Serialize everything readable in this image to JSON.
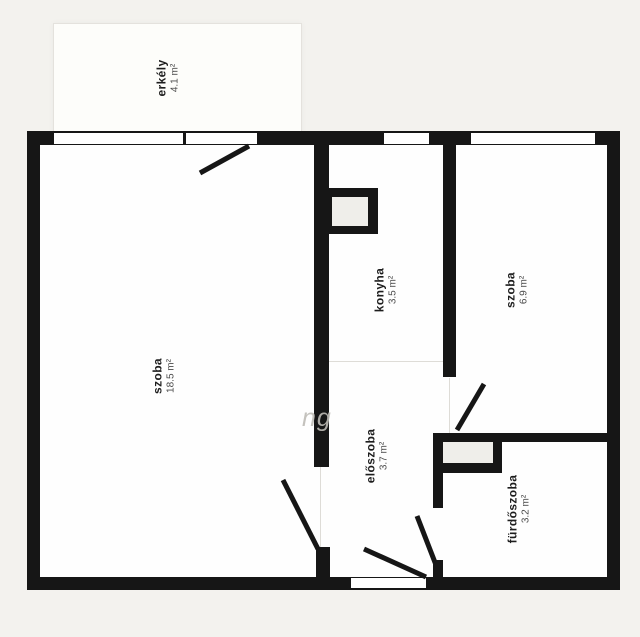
{
  "plan_type": "apartment-floor-plan",
  "colors": {
    "background": "#f3f2ee",
    "wall": "#161616",
    "room_fill": "#fefefe",
    "balcony_fill": "#fdfdfa",
    "shaft_fill": "#efeeea",
    "label_name": "#1d1d1d",
    "label_area": "#4a4a4a",
    "watermark": "#bebbb6"
  },
  "rooms": [
    {
      "name": "erkély",
      "area": "4.1 m²"
    },
    {
      "name": "szoba",
      "area": "18.5 m²"
    },
    {
      "name": "konyha",
      "area": "3.5 m²"
    },
    {
      "name": "szoba",
      "area": "6.9 m²"
    },
    {
      "name": "előszoba",
      "area": "3.7 m²"
    },
    {
      "name": "fürdőszoba",
      "area": "3.2 m²"
    }
  ],
  "watermark": "ng"
}
